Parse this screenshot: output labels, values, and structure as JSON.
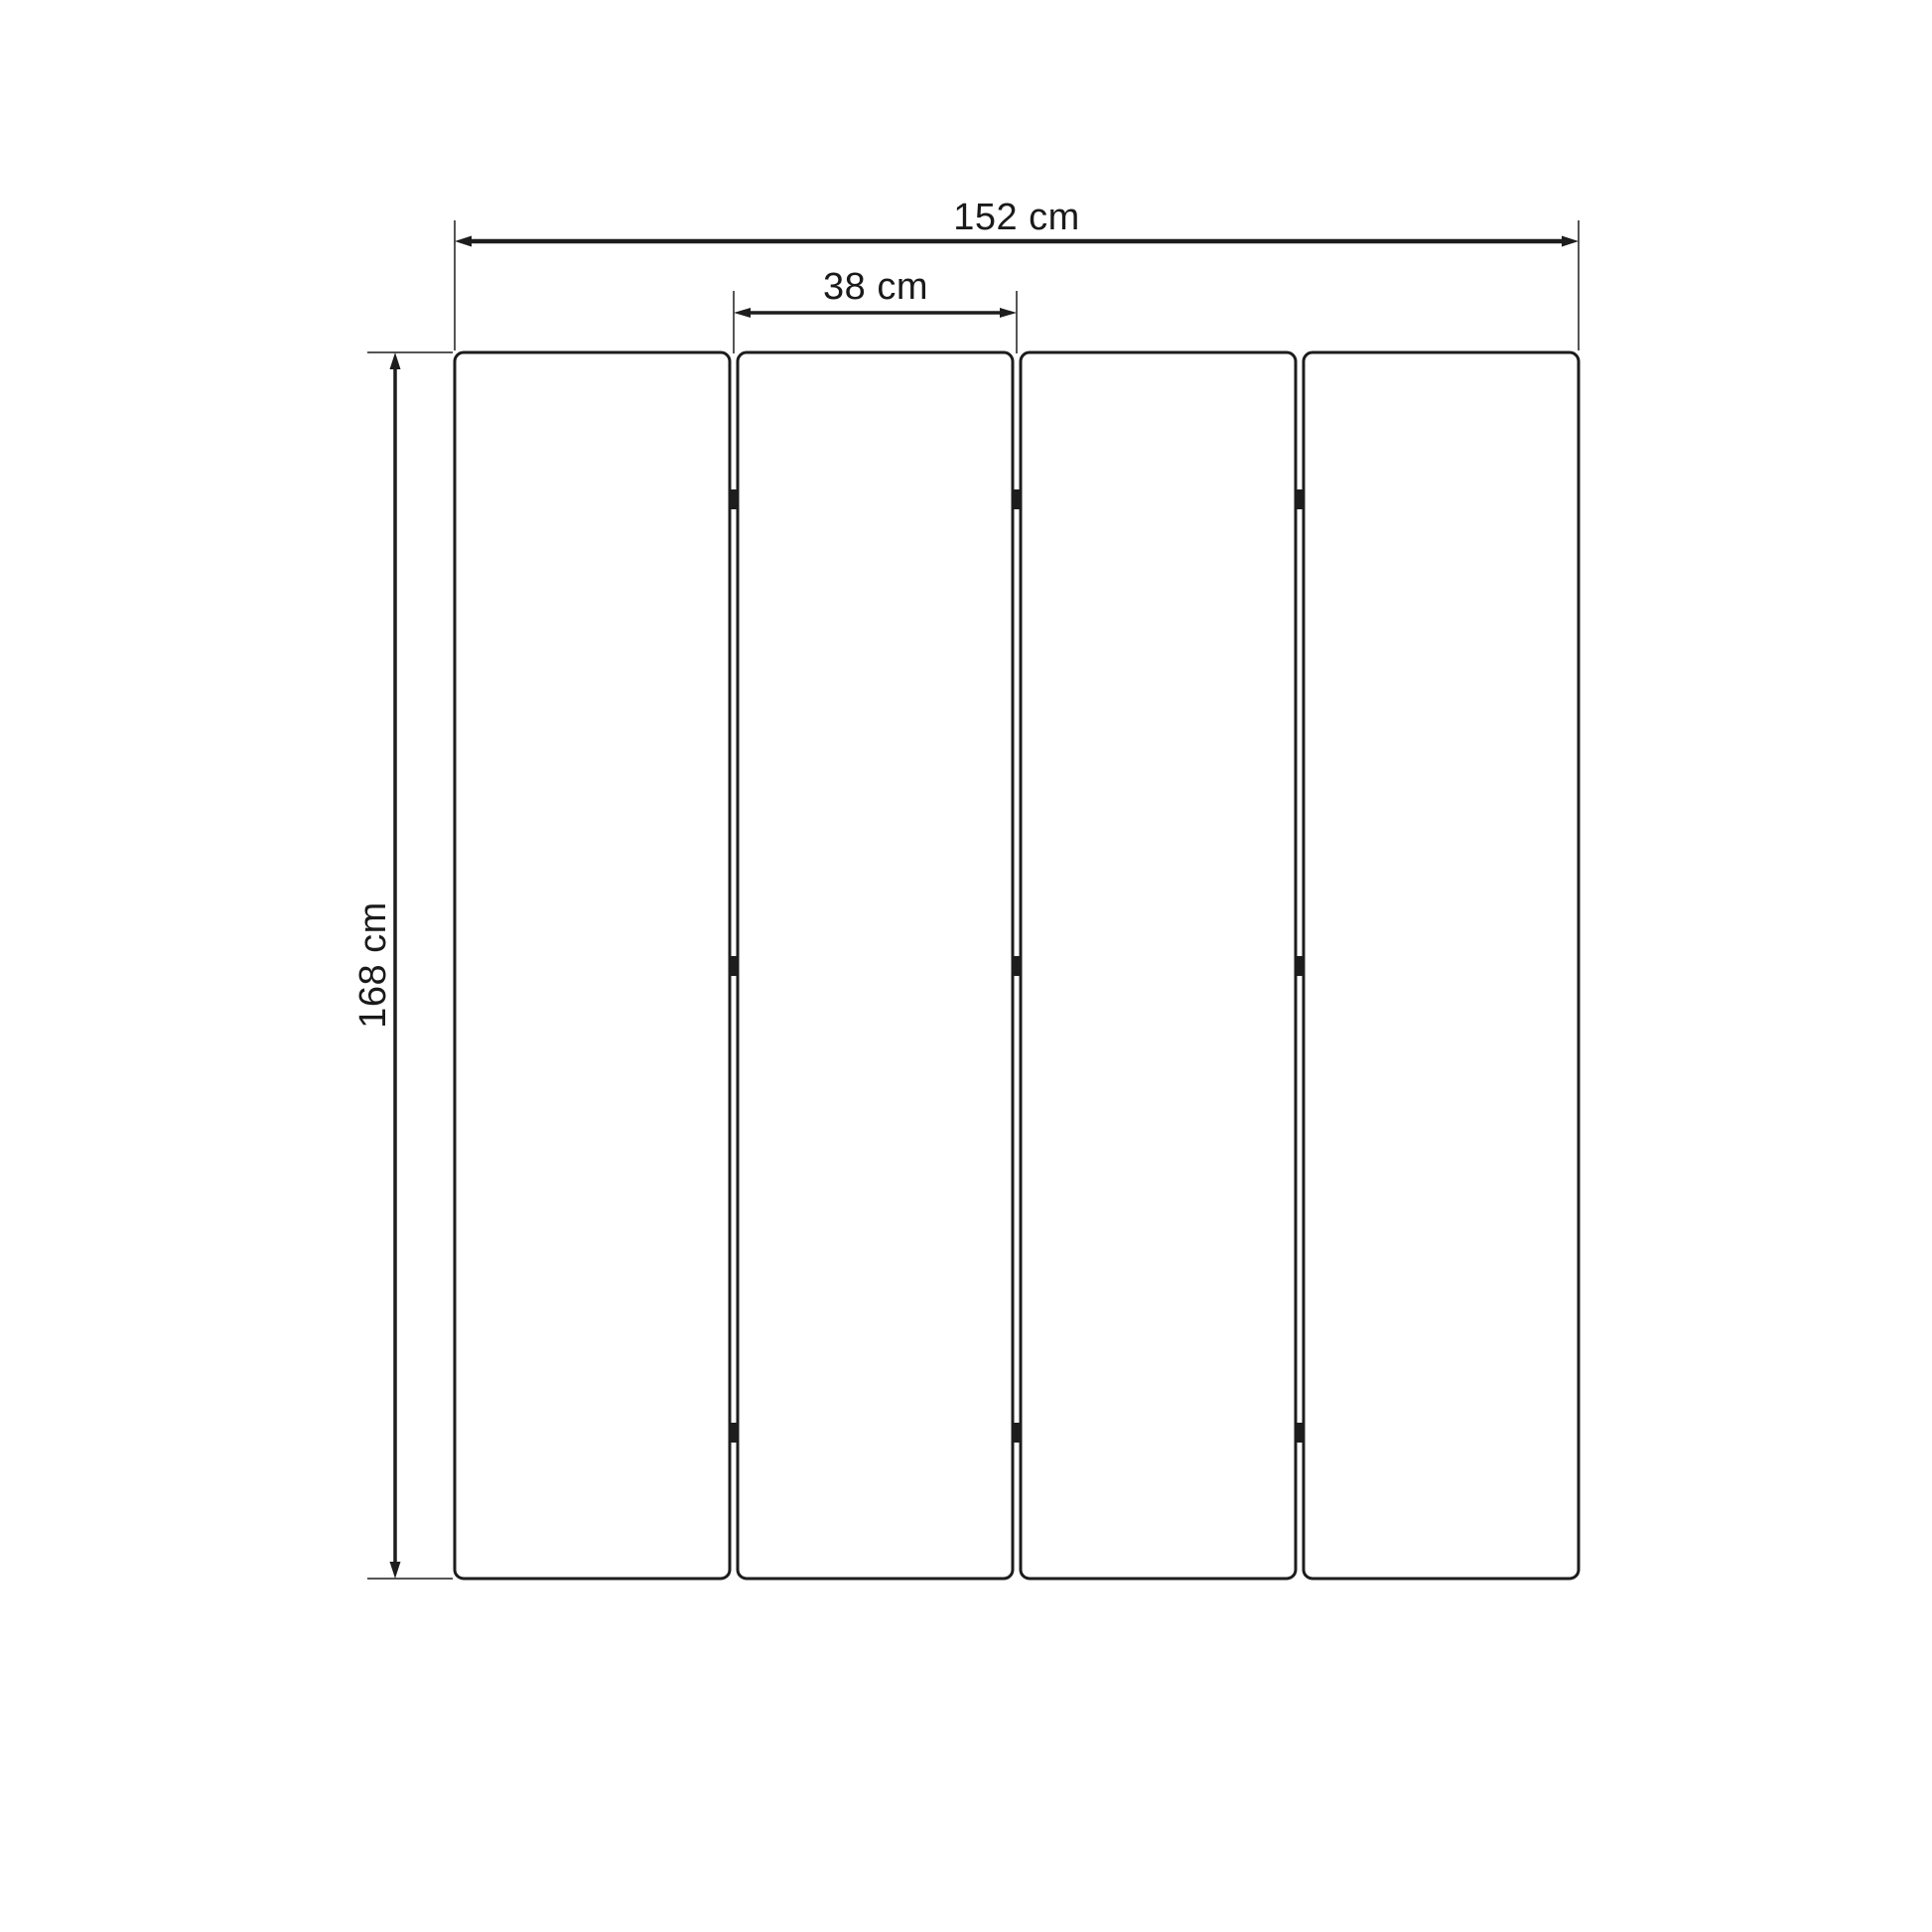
{
  "diagram": {
    "subject": "four-panel folding screen dimension drawing",
    "panel_count": 4,
    "hinge_rows": 3,
    "dimensions": {
      "total_width": {
        "value": 152,
        "unit": "cm",
        "label": "152 cm"
      },
      "panel_width": {
        "value": 38,
        "unit": "cm",
        "label": "38 cm"
      },
      "height": {
        "value": 168,
        "unit": "cm",
        "label": "168 cm"
      }
    },
    "colors": {
      "line": "#1d1d1d",
      "text": "#1a1a1a",
      "background": "#ffffff"
    }
  }
}
